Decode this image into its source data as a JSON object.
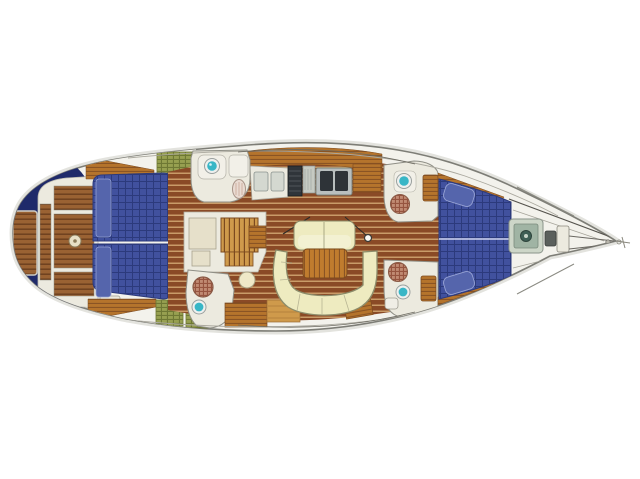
{
  "canvas": {
    "width": 640,
    "height": 479,
    "background": "#ffffff"
  },
  "palette": {
    "hull_fill": "#f3f2ec",
    "hull_stroke": "#7d7d76",
    "hull_shadow": "#e3e3de",
    "navy": "#1f2a6a",
    "deck_white": "#eceadf",
    "teak_base": "#9a6233",
    "teak_line": "#5f3517",
    "sole_base": "#8a4a26",
    "sole_stripe": "#d9af78",
    "wood_mid": "#b5742c",
    "wood_grain": "#8a5424",
    "wood_dark": "#7c4a1f",
    "wood_light": "#cf9a4b",
    "berth_blue": "#41519e",
    "berth_grid": "#2c3a7c",
    "berth_seam": "#cfd4ee",
    "pillow_blue": "#5565ac",
    "cushion": "#eeebc0",
    "cushion_light": "#f3f1d2",
    "cushion_stroke": "#8c8c6a",
    "table_wood": "#c07c2e",
    "sink_turquoise": "#38b6c6",
    "fixture_white": "#f2f0e8",
    "toilet": "#e9dbd2",
    "grate_base": "#c08a72",
    "grate_line": "#96543f",
    "olive": "#97a050",
    "olive_line": "#6e7834",
    "steel": "#b9bfbf",
    "appliance_dark": "#2e3338",
    "stove_dark": "#30353a",
    "vent_gray": "#c6cac2",
    "windlass_frame": "#cdd6c8",
    "windlass_inner": "#a0b4a4",
    "windlass_motor": "#3f5f55",
    "pedestal": "#e8e0c6",
    "line_dark": "#55534d",
    "line_soft": "#a6a49a"
  }
}
